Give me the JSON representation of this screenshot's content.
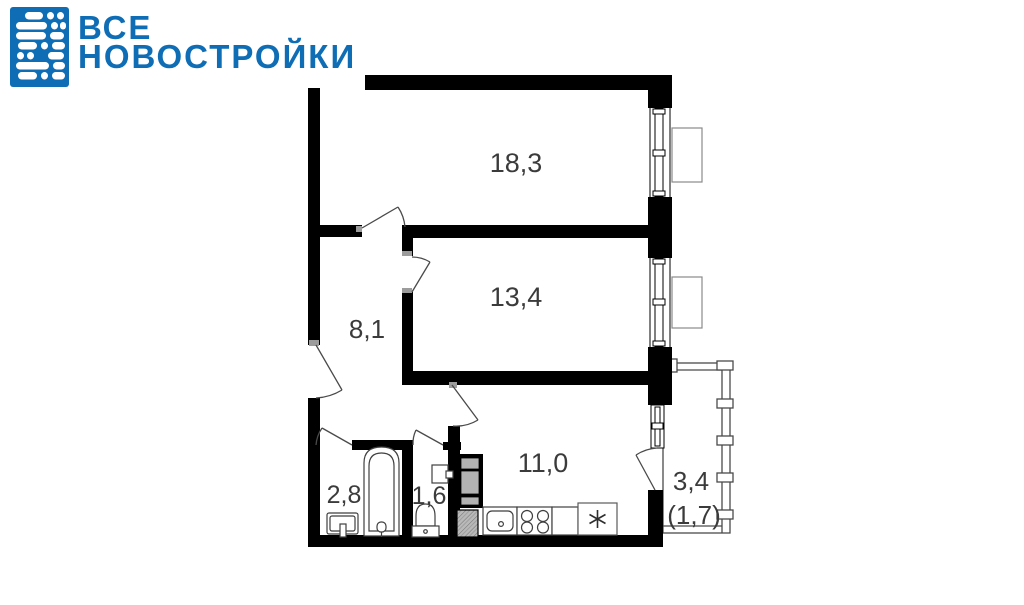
{
  "logo": {
    "line1": "ВСЕ",
    "line2": "НОВОСТРОЙКИ",
    "brand_color": "#0e6db4",
    "icon": "building-dots-icon"
  },
  "floor_plan": {
    "labels": {
      "room_large": "18,3",
      "room_medium": "13,4",
      "hallway": "8,1",
      "bathroom": "2,8",
      "toilet": "1,6",
      "kitchen": "11,0",
      "balcony": "3,4",
      "balcony_reduced": "(1,7)"
    },
    "fixtures": [
      "bathtub",
      "bath-sink",
      "toilet",
      "toilet-sink",
      "kitchen-sink",
      "stove",
      "fridge",
      "vent-shaft"
    ],
    "colors": {
      "wall": "#000000",
      "line": "#4a4a4a",
      "light_line": "#8a8a8a",
      "label": "#3b3b3b",
      "appliance_fill": "#b3b3b3",
      "jamb": "#9c9c9c"
    }
  }
}
